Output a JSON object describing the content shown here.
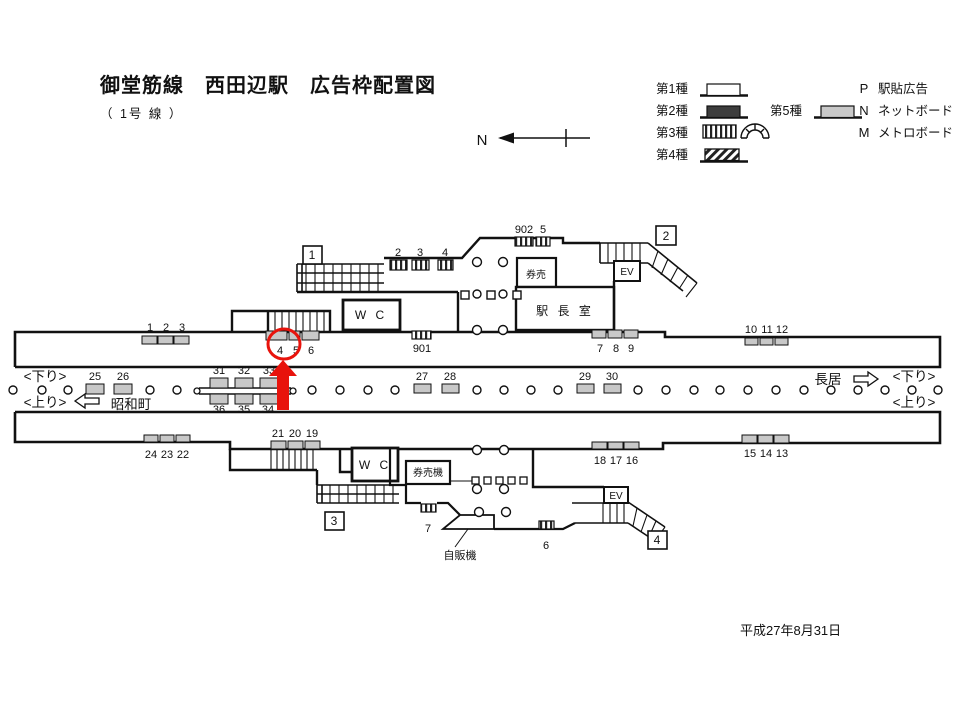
{
  "title": "御堂筋線　西田辺駅　広告枠配置図",
  "subtitle": "（ 1号 線 ）",
  "compass_label": "N",
  "date": "平成27年8月31日",
  "colors": {
    "highlight": "#e8130c",
    "slot_gray": "#c8c8c8",
    "type2_dark": "#3d3d3d"
  },
  "legend": {
    "type1": "第1種",
    "type2": "第2種",
    "type3": "第3種",
    "type4": "第4種",
    "type5": "第5種",
    "p_code": "P",
    "p_label": "駅貼広告",
    "n_code": "N",
    "n_label": "ネットボード",
    "m_code": "M",
    "m_label": "メトロボード"
  },
  "stairs": {
    "s1": "1",
    "s2": "2",
    "s3": "3",
    "s4": "4"
  },
  "rooms": {
    "wc_upper": "W C",
    "wc_lower": "W C",
    "ticket_office": "券売",
    "station_master": "駅 長 室",
    "ticket_machines": "券売機",
    "vending": "自販機",
    "ev_upper": "EV",
    "ev_lower": "EV"
  },
  "directions": {
    "left_down": "<下り>",
    "left_up": "<上り>",
    "right_down": "<下り>",
    "right_up": "<上り>",
    "prev_station": "昭和町",
    "next_station": "長居"
  },
  "slots": {
    "up_wall_left": [
      "1",
      "2",
      "3"
    ],
    "up_wall_circled": [
      "4",
      "5",
      "6"
    ],
    "up_wall_901": "901",
    "up_wall_789": [
      "7",
      "8",
      "9"
    ],
    "up_wall_right": [
      "10",
      "11",
      "12"
    ],
    "conc_up_234": [
      "2",
      "3",
      "4"
    ],
    "conc_up_902_5": [
      "902",
      "5"
    ],
    "plat_25_26": [
      "25",
      "26"
    ],
    "plat_27_28": [
      "27",
      "28"
    ],
    "plat_29_30": [
      "29",
      "30"
    ],
    "beam_top": [
      "31",
      "32",
      "33"
    ],
    "beam_bottom": [
      "36",
      "35",
      "34"
    ],
    "low_wall_24_22": [
      "24",
      "23",
      "22"
    ],
    "low_wall_21_19": [
      "21",
      "20",
      "19"
    ],
    "low_wall_18_16": [
      "18",
      "17",
      "16"
    ],
    "low_wall_15_13": [
      "15",
      "14",
      "13"
    ],
    "conc_low_7": "7",
    "conc_low_6": "6"
  }
}
